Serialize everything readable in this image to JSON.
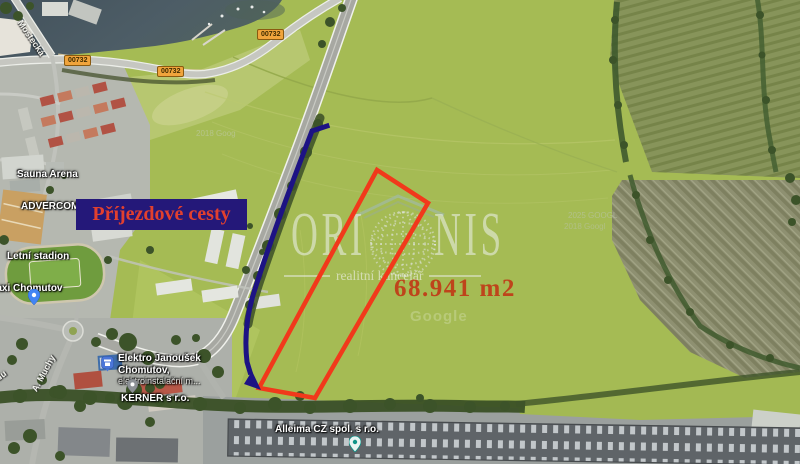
{
  "map": {
    "road_badges": [
      {
        "label": "00732"
      },
      {
        "label": "00732"
      },
      {
        "label": "00732"
      }
    ],
    "streets": {
      "mostecka": "Mostecká",
      "a_muchy": "A. Muchy",
      "nadu_fragment": "nádu"
    },
    "places": {
      "sauna_arena": "Sauna Arena",
      "advercom": "ADVERCOM s.",
      "letni_stadion": "Letní stadion",
      "taxi_chomutov": "Taxi Chomutov",
      "elektro_line1": "Elektro Janoušek",
      "elektro_line2": "Chomutov,",
      "elektro_line3": "elektroinstalační m...",
      "kerner": "KERNER s r.o.",
      "alleima": "Alleima CZ spol. s r.o."
    },
    "credits": {
      "line1": "2025 GOOGL",
      "line2": "2018 Googl",
      "google": "Google",
      "corner": "2018 Goog"
    }
  },
  "annotations": {
    "access_roads_label": "Příjezdové cesty",
    "area_label": "68.941 m2",
    "colors": {
      "parcel": "#f1391b",
      "route": "#1d1384",
      "label_box": "#241879",
      "label_text": "#e2402e",
      "area_text": "#c3290f",
      "badge": "#f0a43c"
    }
  },
  "watermark": {
    "brand_left": "ORI",
    "brand_right": "NIS",
    "tagline": "realitní kancelář"
  }
}
